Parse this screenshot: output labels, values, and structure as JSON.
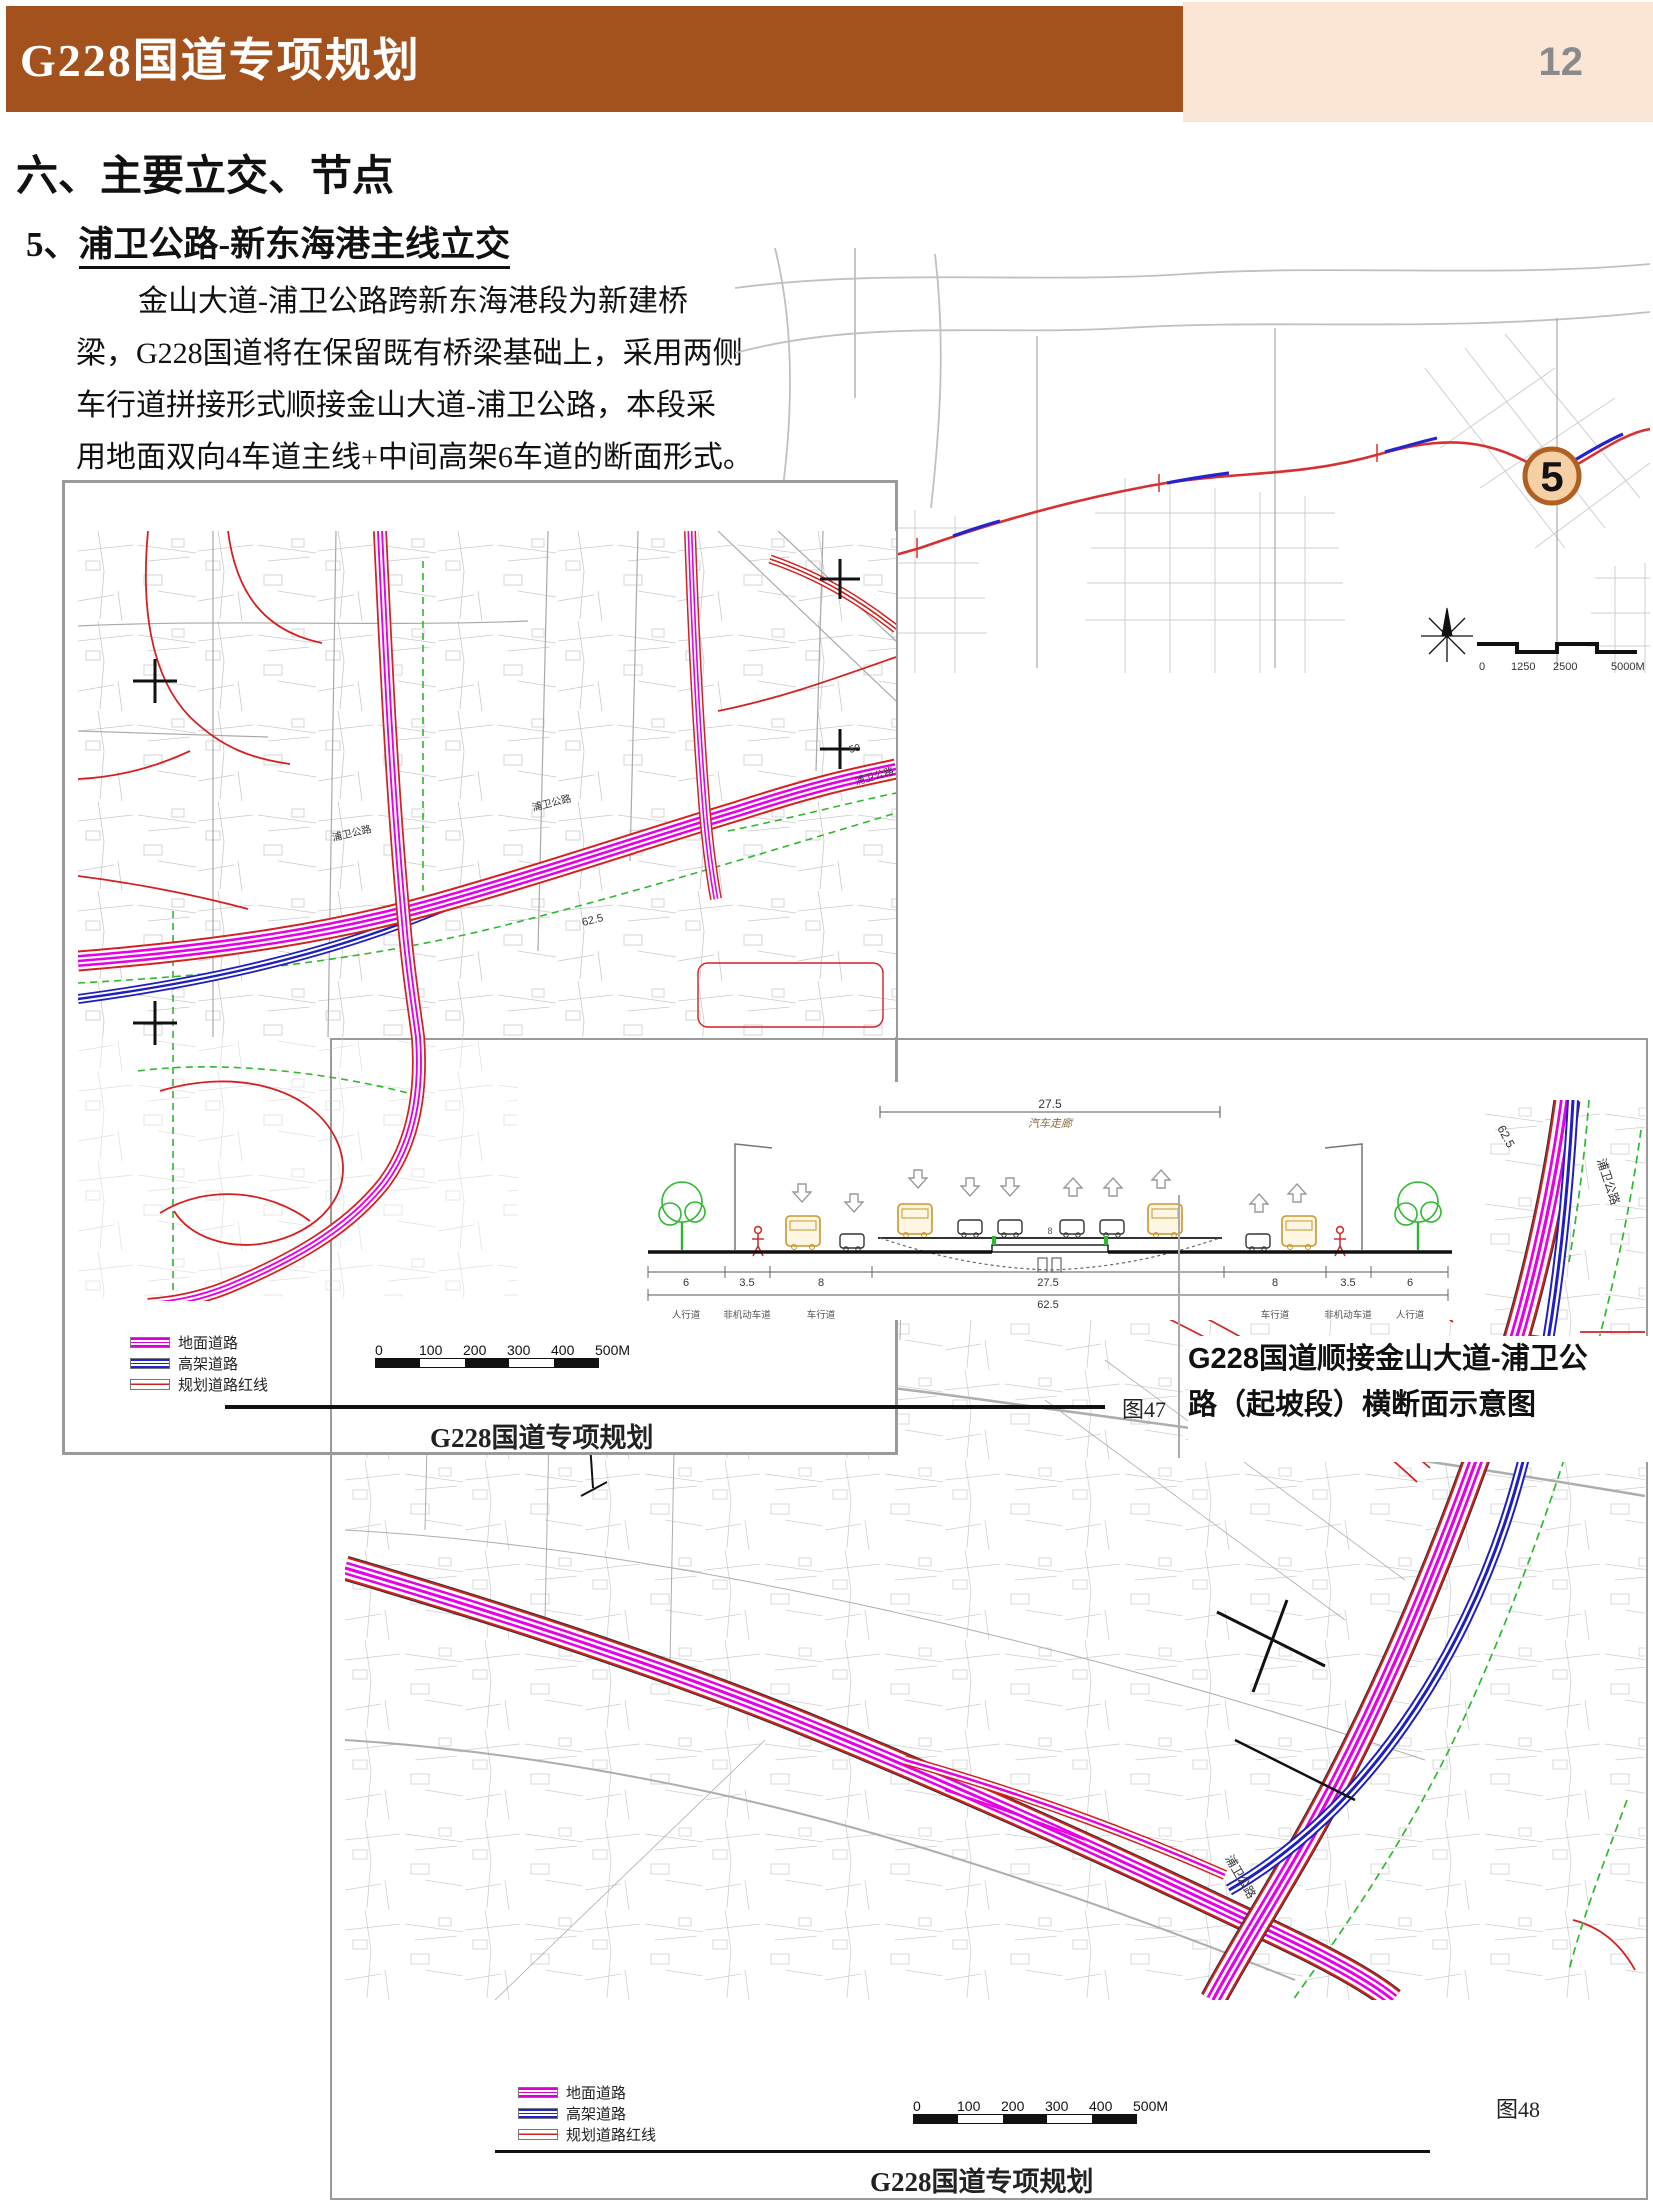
{
  "header": {
    "title": "G228国道专项规划",
    "page_number": "12"
  },
  "section": {
    "heading": "六、主要立交、节点",
    "subheading_prefix": "5、",
    "subheading": "浦卫公路-新东海港主线立交"
  },
  "paragraph": {
    "lines": [
      "金山大道-浦卫公路跨新东海港段为新建桥",
      "梁，G228国道将在保留既有桥梁基础上，采用两侧",
      "车行道拼接形式顺接金山大道-浦卫公路，本段采",
      "用地面双向4车道主线+中间高架6车道的断面形式。"
    ]
  },
  "locator": {
    "marker": "5",
    "scale_labels": [
      "0",
      "1250",
      "2500",
      "5000M"
    ]
  },
  "fig47": {
    "legend": [
      "地面道路",
      "高架道路",
      "规划道路红线"
    ],
    "scale_labels": [
      "0",
      "100",
      "200",
      "300",
      "400",
      "500M"
    ],
    "figure_label": "图47",
    "caption": "G228国道专项规划",
    "road_label": "浦卫公路",
    "dim_62": "62.5",
    "num_50": "50"
  },
  "cross_section": {
    "top_dim": "27.5",
    "top_label": "汽车走廊",
    "center_dim": "8",
    "total_dim": "62.5",
    "bottom_dims": [
      "6",
      "3.5",
      "8",
      "27.5",
      "8",
      "3.5",
      "6"
    ],
    "lane_labels": [
      "人行道",
      "非机动车道",
      "车行道",
      "车行道",
      "非机动车道",
      "人行道"
    ],
    "caption_line1": "G228国道顺接金山大道-浦卫公",
    "caption_line2": "路（起坡段）横断面示意图"
  },
  "fig48": {
    "legend": [
      "地面道路",
      "高架道路",
      "规划道路红线"
    ],
    "scale_labels": [
      "0",
      "100",
      "200",
      "300",
      "400",
      "500M"
    ],
    "figure_label": "图48",
    "caption": "G228国道专项规划",
    "road_label": "浦卫公路",
    "dim_62": "62.5",
    "compass": "N"
  },
  "colors": {
    "accent_brown": "#a4521d",
    "peach": "#fbe5d5",
    "ground_road": "#e500e5",
    "elevated_road": "#2222cc",
    "red_line": "#d42020"
  }
}
